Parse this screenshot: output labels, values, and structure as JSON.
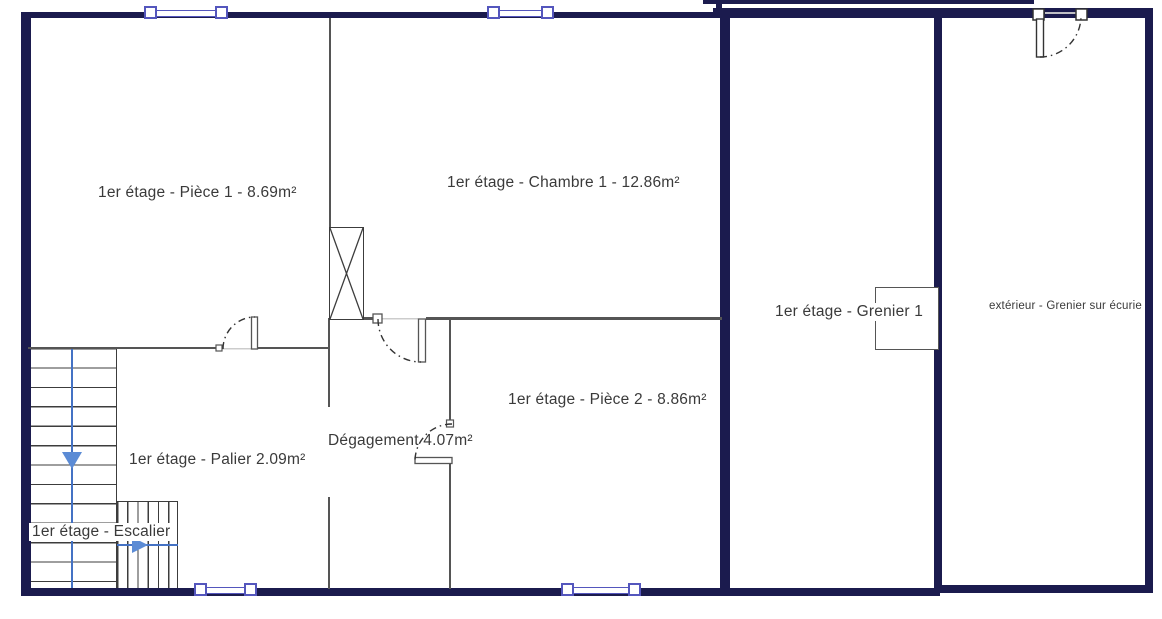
{
  "plan": {
    "rooms": [
      {
        "id": "piece1",
        "label": "1er étage - Pièce 1 - 8.69m²"
      },
      {
        "id": "chambre1",
        "label": "1er étage - Chambre 1 - 12.86m²"
      },
      {
        "id": "grenier1",
        "label": "1er étage - Grenier 1"
      },
      {
        "id": "grenier_ecurie",
        "label": "extérieur - Grenier sur écurie"
      },
      {
        "id": "piece2",
        "label": "1er étage - Pièce 2 - 8.86m²"
      },
      {
        "id": "degagement",
        "label": "Dégagement 4.07m²"
      },
      {
        "id": "palier",
        "label": "1er étage - Palier 2.09m²"
      },
      {
        "id": "escalier",
        "label": "1er étage - Escalier"
      }
    ],
    "colors": {
      "outer_wall": "#1b1b4e",
      "inner_wall": "#555555",
      "window_accent": "#5456bd",
      "stair_guide": "#4472c4",
      "stair_arrow": "#5b8bd5",
      "label_text": "#3a3a3a"
    }
  }
}
